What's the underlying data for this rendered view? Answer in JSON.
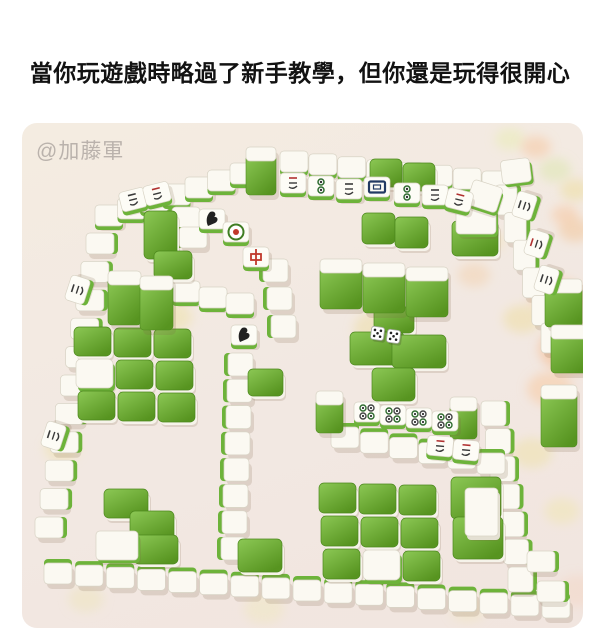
{
  "caption": "當你玩遊戲時略過了新手教學，但你還是玩得很開心",
  "photo": {
    "watermark": "@加藤軍",
    "colors": {
      "caption": "#121212",
      "watermark": "#b7b0aa",
      "carpet_top": "#f4ece1",
      "carpet_bottom": "#f1e5df",
      "tile_white": "#fbf9f2",
      "tile_stroke": "#d8d3c5",
      "green_light": "#8cc855",
      "green_dark": "#579420",
      "green_edge": "#6db33a",
      "shadow": "rgba(125,100,72,0.18)"
    },
    "blobs": [
      [
        533,
        47,
        12,
        "#dce8b0"
      ],
      [
        553,
        67,
        11,
        "#eddfa0"
      ],
      [
        543,
        92,
        10,
        "#f5c9a2"
      ],
      [
        553,
        107,
        12,
        "#f3c79c"
      ],
      [
        488,
        16,
        11,
        "#e9edb6"
      ],
      [
        514,
        24,
        11,
        "#f5c9a2"
      ],
      [
        535,
        175,
        20,
        "#f7c89e"
      ],
      [
        549,
        226,
        24,
        "#f5bb8e"
      ],
      [
        528,
        266,
        17,
        "#f7cba3"
      ],
      [
        500,
        196,
        14,
        "#eedfa4"
      ],
      [
        452,
        152,
        12,
        "#f3d4b2"
      ],
      [
        468,
        118,
        10,
        "#f0e2ae"
      ],
      [
        356,
        206,
        18,
        "#ecdfa8"
      ],
      [
        150,
        194,
        15,
        "#efe2ab"
      ],
      [
        40,
        326,
        13,
        "#efe3b0"
      ],
      [
        510,
        330,
        15,
        "#eee1ac"
      ],
      [
        540,
        388,
        13,
        "#f1e5b4"
      ],
      [
        556,
        468,
        16,
        "#f3d7c6"
      ],
      [
        64,
        476,
        13,
        "#efe5bf"
      ],
      [
        242,
        486,
        15,
        "#f1e7c3"
      ],
      [
        446,
        486,
        13,
        "#f0e6c2"
      ]
    ],
    "wall_runs": [
      {
        "x1": 73,
        "y1": 82,
        "x2": 208,
        "y2": 40,
        "n": 7,
        "e": "s"
      },
      {
        "x1": 258,
        "y1": 28,
        "x2": 460,
        "y2": 48,
        "n": 8,
        "e": "s"
      },
      {
        "x1": 64,
        "y1": 110,
        "x2": 13,
        "y2": 394,
        "n": 11,
        "e": "e"
      },
      {
        "x1": 22,
        "y1": 440,
        "x2": 520,
        "y2": 474,
        "n": 17,
        "e": "n"
      },
      {
        "x1": 150,
        "y1": 84,
        "x2": 157,
        "y2": 104,
        "n": 2,
        "e": "w"
      },
      {
        "x1": 150,
        "y1": 158,
        "x2": 204,
        "y2": 170,
        "n": 3,
        "e": "s"
      },
      {
        "x1": 206,
        "y1": 230,
        "x2": 199,
        "y2": 414,
        "n": 8,
        "e": "w",
        "tw": 25,
        "th": 23
      },
      {
        "x1": 241,
        "y1": 136,
        "x2": 249,
        "y2": 192,
        "n": 3,
        "e": "w",
        "tw": 25,
        "th": 23
      },
      {
        "x1": 473,
        "y1": 62,
        "x2": 519,
        "y2": 200,
        "n": 6,
        "e": "e",
        "tw": 22,
        "th": 30
      },
      {
        "x1": 459,
        "y1": 278,
        "x2": 486,
        "y2": 444,
        "n": 7,
        "e": "e",
        "tw": 25,
        "th": 25
      },
      {
        "x1": 309,
        "y1": 304,
        "x2": 455,
        "y2": 330,
        "n": 6,
        "e": "n"
      },
      {
        "x1": 505,
        "y1": 428,
        "x2": 515,
        "y2": 458,
        "n": 2,
        "e": "e"
      }
    ],
    "slabs": [
      {
        "x": 224,
        "y": 24,
        "w": 30,
        "h": 48
      },
      {
        "x": 86,
        "y": 148,
        "w": 33,
        "h": 54
      },
      {
        "x": 118,
        "y": 153,
        "w": 33,
        "h": 54
      },
      {
        "x": 298,
        "y": 136,
        "w": 42,
        "h": 50
      },
      {
        "x": 341,
        "y": 140,
        "w": 42,
        "h": 50
      },
      {
        "x": 384,
        "y": 144,
        "w": 42,
        "h": 50
      },
      {
        "x": 523,
        "y": 156,
        "w": 37,
        "h": 48
      },
      {
        "x": 529,
        "y": 202,
        "w": 37,
        "h": 48
      },
      {
        "x": 519,
        "y": 262,
        "w": 36,
        "h": 62
      },
      {
        "x": 294,
        "y": 268,
        "w": 27,
        "h": 42
      },
      {
        "x": 428,
        "y": 274,
        "w": 27,
        "h": 42
      },
      {
        "x": 443,
        "y": 365,
        "w": 33,
        "h": 48,
        "t": "w"
      }
    ],
    "flats_green": [
      {
        "x": 122,
        "y": 88,
        "w": 33,
        "h": 48
      },
      {
        "x": 132,
        "y": 128,
        "w": 38,
        "h": 28
      },
      {
        "x": 348,
        "y": 36,
        "w": 32,
        "h": 28
      },
      {
        "x": 381,
        "y": 40,
        "w": 32,
        "h": 28
      },
      {
        "x": 340,
        "y": 90,
        "w": 33,
        "h": 31
      },
      {
        "x": 373,
        "y": 94,
        "w": 33,
        "h": 31
      },
      {
        "x": 352,
        "y": 184,
        "w": 40,
        "h": 26
      },
      {
        "x": 328,
        "y": 209,
        "w": 54,
        "h": 33
      },
      {
        "x": 370,
        "y": 212,
        "w": 54,
        "h": 33
      },
      {
        "x": 350,
        "y": 245,
        "w": 43,
        "h": 33
      },
      {
        "x": 430,
        "y": 98,
        "w": 46,
        "h": 35
      },
      {
        "x": 226,
        "y": 246,
        "w": 35,
        "h": 27
      },
      {
        "x": 216,
        "y": 416,
        "w": 44,
        "h": 33
      },
      {
        "x": 82,
        "y": 366,
        "w": 44,
        "h": 29
      },
      {
        "x": 108,
        "y": 388,
        "w": 44,
        "h": 29
      },
      {
        "x": 112,
        "y": 412,
        "w": 44,
        "h": 29
      },
      {
        "x": 429,
        "y": 354,
        "w": 50,
        "h": 42
      },
      {
        "x": 431,
        "y": 394,
        "w": 50,
        "h": 42
      }
    ],
    "flats_white": [
      {
        "x": 434,
        "y": 84,
        "w": 40,
        "h": 27
      },
      {
        "x": 74,
        "y": 408,
        "w": 42,
        "h": 29
      },
      {
        "x": 452,
        "y": 56,
        "w": 31,
        "h": 26,
        "a": 18
      },
      {
        "x": 478,
        "y": 38,
        "w": 29,
        "h": 24,
        "a": -7
      }
    ],
    "clusters": [
      {
        "x": 52,
        "y": 204,
        "cols": 3,
        "rows": 3,
        "tw": 37,
        "th": 29,
        "white": [
          [
            1,
            0
          ]
        ]
      },
      {
        "x": 297,
        "y": 360,
        "cols": 3,
        "rows": 3,
        "tw": 37,
        "th": 30,
        "white": [
          [
            2,
            1
          ]
        ]
      }
    ],
    "faces": [
      {
        "x": 177,
        "y": 86,
        "s": "bird"
      },
      {
        "x": 201,
        "y": 99,
        "s": "c1"
      },
      {
        "x": 221,
        "y": 124,
        "s": "zh"
      },
      {
        "x": 209,
        "y": 202,
        "s": "bird"
      },
      {
        "x": 258,
        "y": 50,
        "s": "charsR"
      },
      {
        "x": 286,
        "y": 53,
        "s": "dots2"
      },
      {
        "x": 314,
        "y": 56,
        "s": "chars"
      },
      {
        "x": 342,
        "y": 54,
        "s": "frame"
      },
      {
        "x": 372,
        "y": 60,
        "s": "dots2"
      },
      {
        "x": 400,
        "y": 62,
        "s": "chars"
      },
      {
        "x": 427,
        "y": 64,
        "s": "charsR",
        "a": 14
      },
      {
        "x": 96,
        "y": 70,
        "s": "chars",
        "a": -14
      },
      {
        "x": 120,
        "y": 64,
        "s": "charsR",
        "a": -14
      },
      {
        "x": 42,
        "y": 176,
        "s": "chars",
        "a": -72
      },
      {
        "x": 18,
        "y": 322,
        "s": "chars",
        "a": -72
      },
      {
        "x": 332,
        "y": 279,
        "s": "dots4"
      },
      {
        "x": 358,
        "y": 282,
        "s": "dots4"
      },
      {
        "x": 384,
        "y": 285,
        "s": "dots4"
      },
      {
        "x": 410,
        "y": 288,
        "s": "dots4"
      },
      {
        "x": 406,
        "y": 312,
        "s": "charsR",
        "a": 5
      },
      {
        "x": 432,
        "y": 316,
        "s": "charsR",
        "a": 5
      },
      {
        "x": 489,
        "y": 92,
        "s": "chars",
        "a": -72
      },
      {
        "x": 501,
        "y": 130,
        "s": "charsR",
        "a": -72
      },
      {
        "x": 511,
        "y": 166,
        "s": "chars",
        "a": -72
      }
    ],
    "dice": [
      {
        "x": 350,
        "y": 203
      },
      {
        "x": 366,
        "y": 206
      }
    ]
  }
}
